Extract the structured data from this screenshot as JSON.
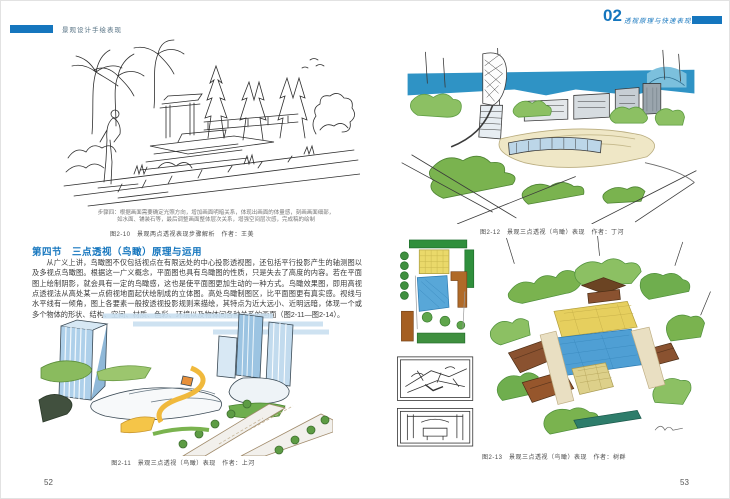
{
  "book": {
    "colors": {
      "accent_blue": "#1576be"
    },
    "left_page": {
      "running_header": "景观设计手绘表现",
      "page_number": "52",
      "top_figure": {
        "note_line1": "步骤四：根据画面需要确定光照方向，增加画面明暗关系，体现出画面的体量感，刻画画面细部，",
        "note_line2": "如水面、铺装石等，最后调整画面整体层次关系，增强空间层次感，完成稿的绘制",
        "caption": "图2-10　景观两点透视表现步骤解析　作者：王美"
      },
      "section": {
        "heading": "第四节　三点透视（鸟瞰）原理与运用",
        "paragraph": "从广义上讲，鸟瞰图不仅包括视点在有限远处的中心投影透视图，还包括平行投影产生的轴测图以及多视点鸟瞰图。根据这一广义概念，平面图也具有鸟瞰图的性质，只是失去了高度的内容。若在平面图上绘制阴影，就会具有一定的鸟瞰感，这也是使平面图更加生动的一种方式。鸟瞰效果图，即用高视点透视法从高处某一点俯视地面起伏绘制成的立体图。高处鸟瞰制图区，比平面图更有真实感。视线与水平线有一倾角，图上各要素一般按透视投影规则来描绘，其特点为近大远小、近明远暗，体现一个或多个物体的形状、结构、空间、材质、色彩、环境以及物体间各种关系的画面（图2-11—图2-14）。"
      },
      "bottom_figure": {
        "caption": "图2-11　景观三点透视（鸟瞰）表现　作者：上河"
      }
    },
    "right_page": {
      "chapter_number": "02",
      "running_header": "透视原理与快速表现方法",
      "page_number": "53",
      "top_figure": {
        "caption": "图2-12　景观三点透视（鸟瞰）表现　作者：丁河"
      },
      "bottom_figure": {
        "caption": "图2-13　景观三点透视（鸟瞰）表现　作者：树群"
      }
    }
  }
}
